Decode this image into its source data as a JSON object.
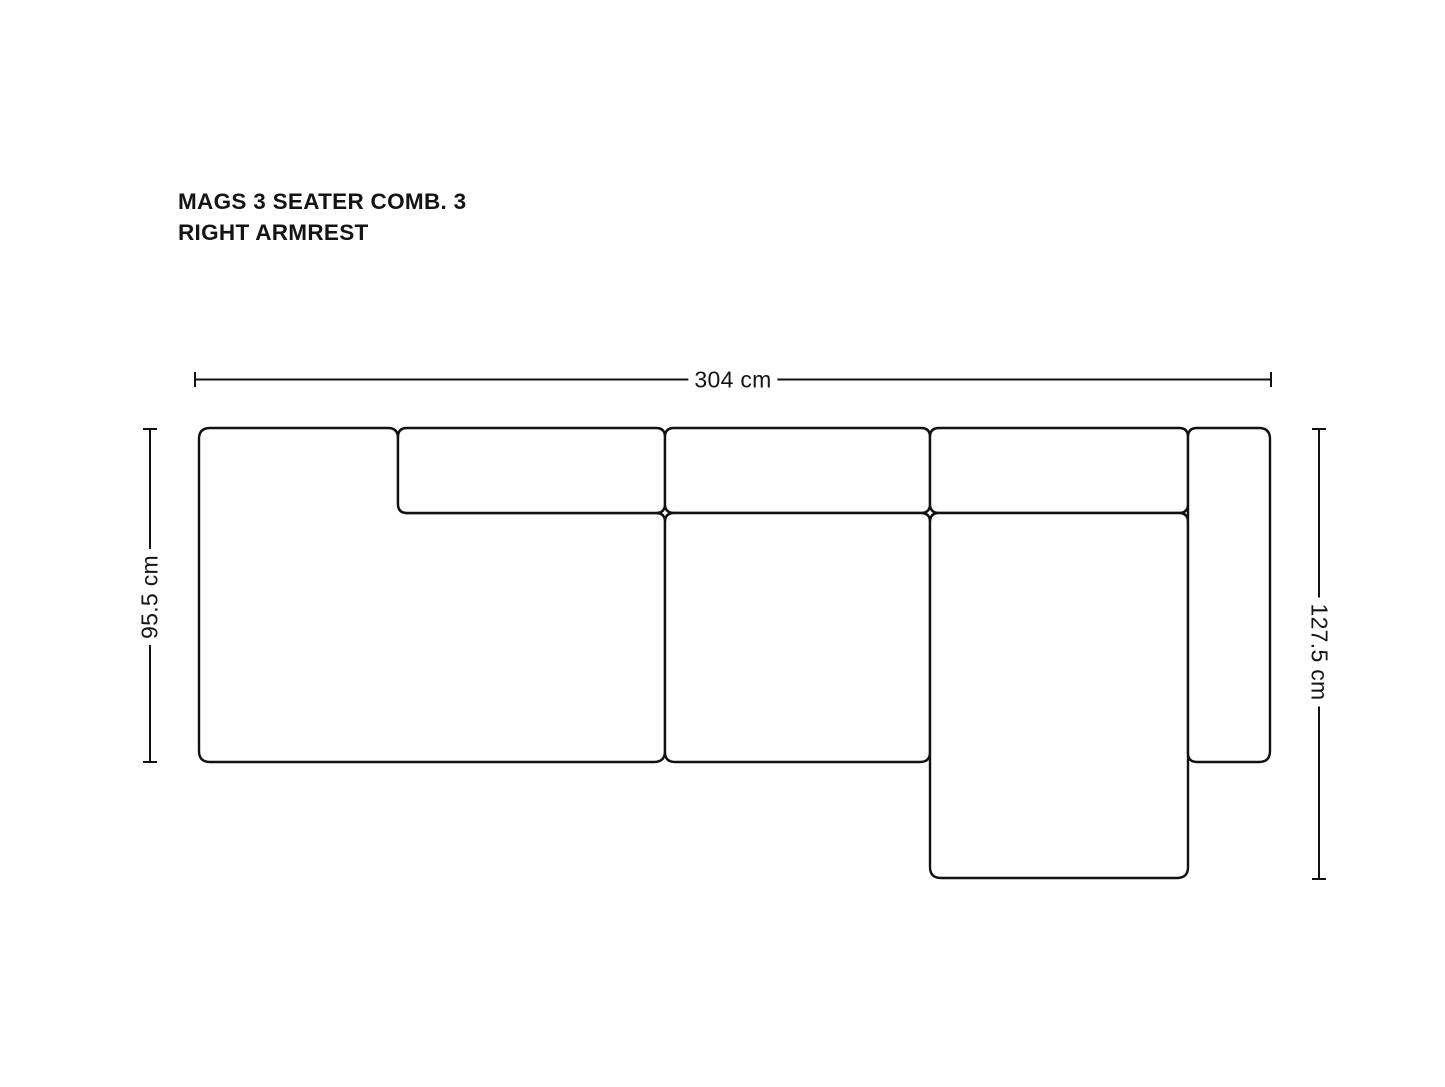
{
  "title": {
    "line1": "MAGS 3 SEATER COMB. 3",
    "line2": "RIGHT ARMREST"
  },
  "dimensions": {
    "width_label": "304 cm",
    "left_depth_label": "95.5 cm",
    "right_depth_label": "127.5 cm"
  },
  "style": {
    "line_color": "#111111",
    "text_color": "#141414",
    "background": "#ffffff"
  }
}
